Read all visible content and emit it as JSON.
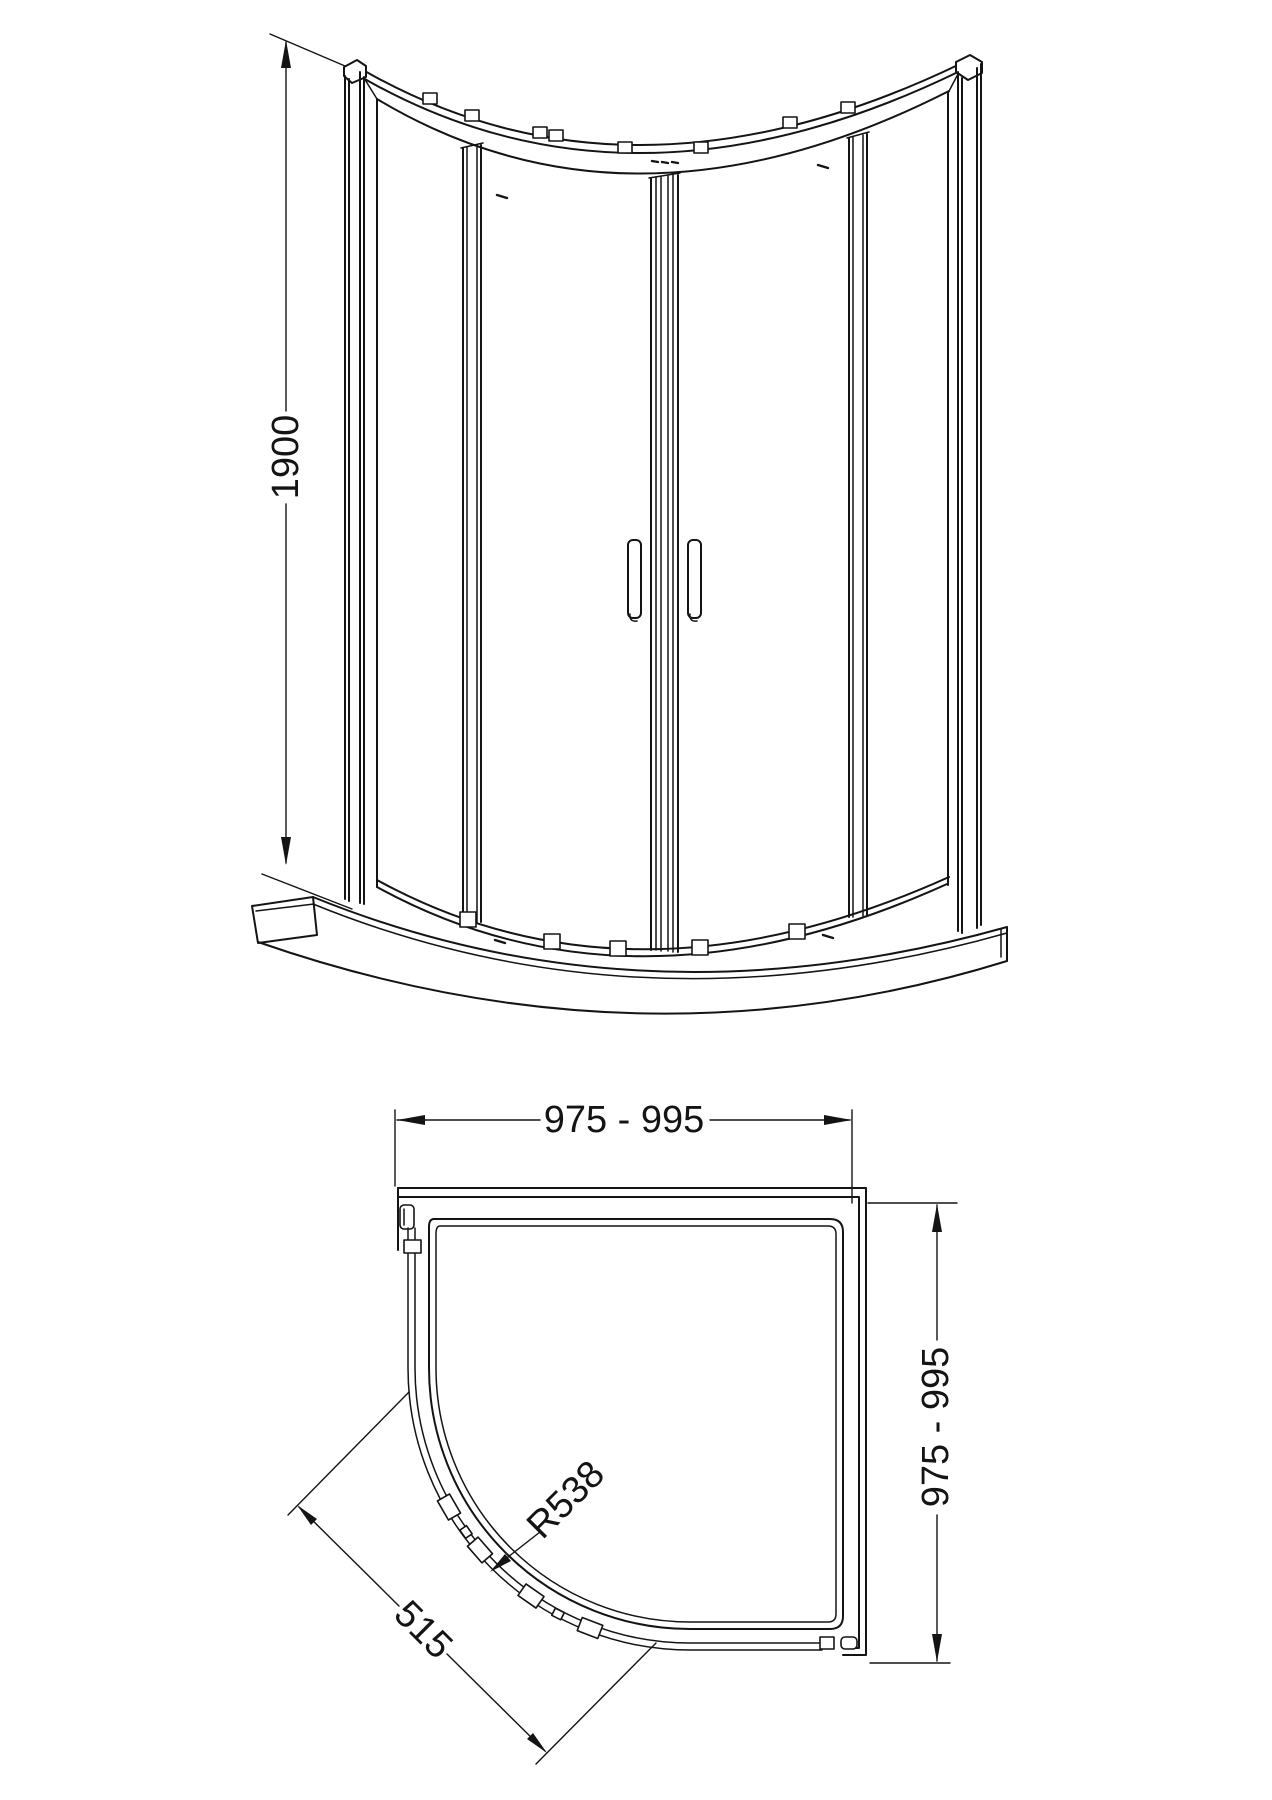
{
  "drawing": {
    "background_color": "#ffffff",
    "line_color": "#141414"
  },
  "views": {
    "front_elevation": {
      "height_dimension": {
        "label": "1900"
      }
    },
    "plan": {
      "width_dimension": {
        "label": "975 - 995"
      },
      "depth_dimension": {
        "label": "975 - 995"
      },
      "radius_dimension": {
        "label": "R538"
      },
      "opening_dimension": {
        "label": "515"
      }
    }
  }
}
